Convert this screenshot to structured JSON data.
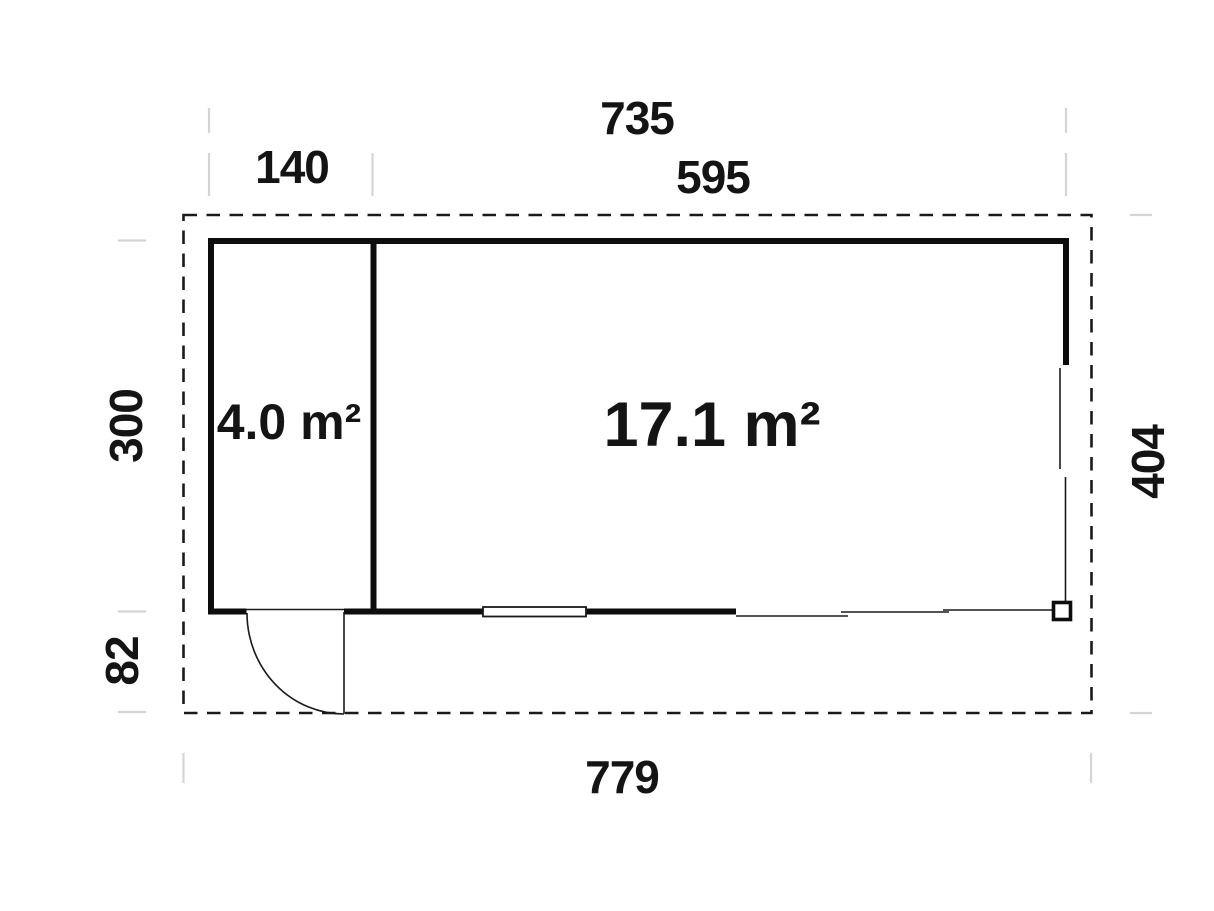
{
  "diagram": {
    "type": "floor-plan",
    "background_color": "#ffffff",
    "line_color": "#141414",
    "tick_color": "#d4d4d4",
    "dimensions": {
      "top_total": "735",
      "top_left_section": "140",
      "top_right_section": "595",
      "left_upper_height": "300",
      "left_lower_height": "82",
      "right_height": "404",
      "bottom_total": "779"
    },
    "rooms": [
      {
        "id": "side-room",
        "area_label": "4.0 m²"
      },
      {
        "id": "main-room",
        "area_label": "17.1 m²"
      }
    ],
    "symbols": [
      "door-swing",
      "window",
      "glazed-wall-segment",
      "corner-post",
      "dashed-roof-outline",
      "dimension-tick"
    ]
  }
}
